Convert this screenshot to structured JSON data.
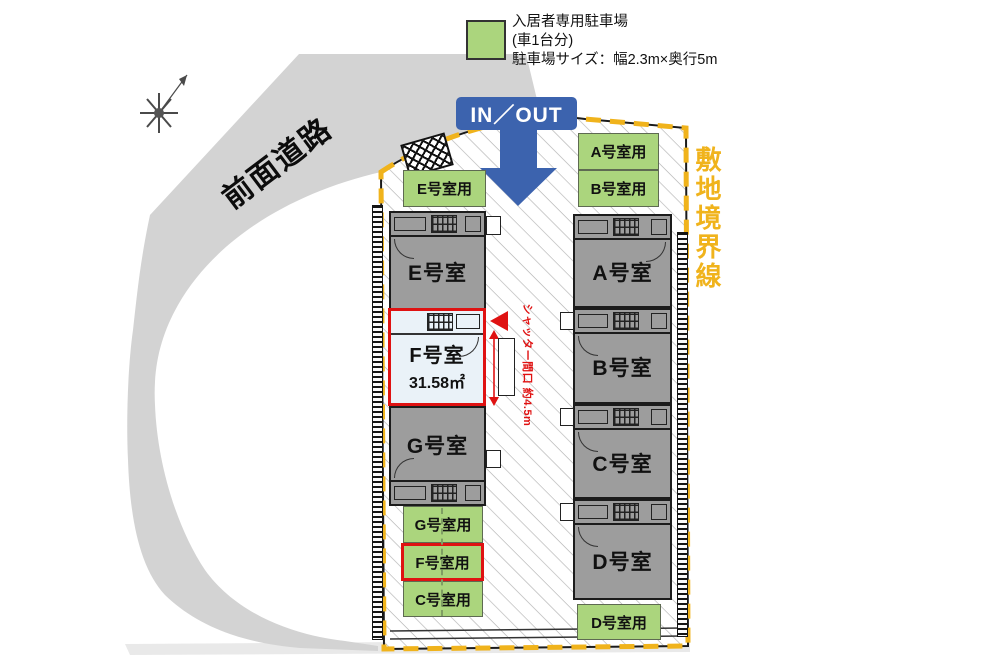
{
  "legend": {
    "title": "入居者専用駐車場",
    "subtitle": "(車1台分)",
    "size_note": "駐車場サイズ：幅2.3m×奥行5m"
  },
  "annotations": {
    "road": "前面道路",
    "boundary": "敷地境界線",
    "in_out": "IN／OUT",
    "shutter": "シャッター間口 約4.5m"
  },
  "units": {
    "E": {
      "label": "E号室"
    },
    "F": {
      "label": "F号室",
      "area": "31.58㎡",
      "highlighted": true
    },
    "G": {
      "label": "G号室"
    },
    "A": {
      "label": "A号室"
    },
    "B": {
      "label": "B号室"
    },
    "C": {
      "label": "C号室"
    },
    "D": {
      "label": "D号室"
    }
  },
  "parking_spots": {
    "E": {
      "label": "E号室用"
    },
    "A": {
      "label": "A号室用"
    },
    "B": {
      "label": "B号室用"
    },
    "G": {
      "label": "G号室用"
    },
    "F": {
      "label": "F号室用",
      "highlighted": true
    },
    "C": {
      "label": "C号室用"
    },
    "D": {
      "label": "D号室用"
    }
  },
  "colors": {
    "parking_green": "#abd57d",
    "unit_gray": "#9d9d9d",
    "road_gray": "#d3d3d3",
    "boundary_yellow": "#f0b31c",
    "highlight_red": "#df1212",
    "arrow_blue": "#3c63ae",
    "highlight_fill": "#eaf2f8"
  }
}
